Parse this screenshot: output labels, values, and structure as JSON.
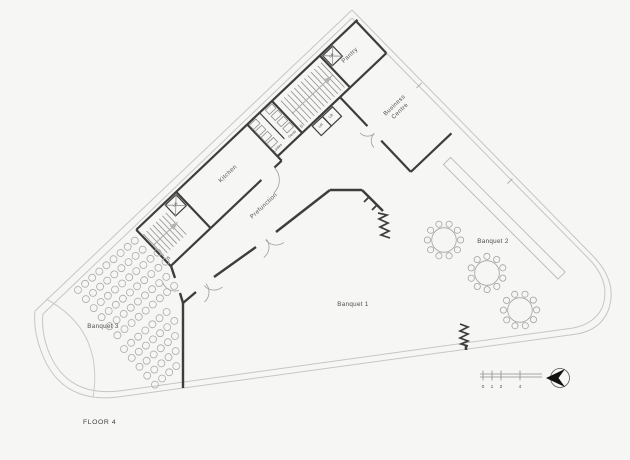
{
  "floor_plan": {
    "title": "FLOOR 4",
    "labels": {
      "pantry": "Pantry",
      "business_centre_line1": "Business",
      "business_centre_line2": "Centre",
      "kitchen": "Kitchen",
      "prefunction": "Prefunction",
      "banquet_1": "Banquet 1",
      "banquet_2": "Banquet 2",
      "banquet_3": "Banquet 3",
      "gents": "Gents",
      "ladies": "Ladies",
      "stair": "S",
      "lift": "Lift"
    },
    "scale_bar": {
      "labels": [
        "0",
        "1",
        "2",
        "4"
      ]
    },
    "icons": {
      "north_arrow": "north-arrow"
    },
    "colors": {
      "wall": "#3d3d3d",
      "site_line": "#c6c6c6",
      "furniture": "#ababab",
      "text": "#4d4d4d",
      "background": "#f6f6f4"
    }
  }
}
